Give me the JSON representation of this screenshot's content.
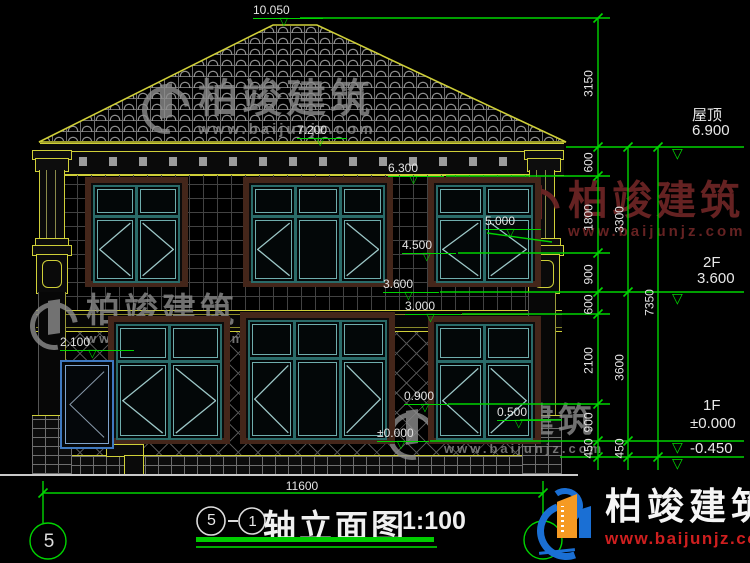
{
  "levels": [
    "10.050",
    "7.200",
    "6.300",
    "5.000",
    "4.500",
    "3.600",
    "3.000",
    "2.100",
    "0.900",
    "0.500",
    "±0.000"
  ],
  "right_panel": {
    "roof_label": "屋顶",
    "roof_level": "6.900",
    "floor2_label": "2F",
    "floor2_level": "3.600",
    "floor1_label": "1F",
    "floor1_level": "±0.000",
    "basement_level": "-0.450",
    "col1": [
      "3150",
      "600",
      "1800",
      "900",
      "600",
      "2100",
      "900",
      "450"
    ],
    "col2": [
      "3300",
      "3600",
      "450"
    ],
    "col3": [
      "7350"
    ]
  },
  "bottom": {
    "overall_dim": "11600",
    "axis_left": "5"
  },
  "title": {
    "axis_a": "5",
    "dash": "-",
    "axis_b": "1",
    "name": "轴立面图",
    "scale": "1:100"
  },
  "brand": {
    "name": "柏竣建筑",
    "url": "www.baijunjz.com"
  },
  "colors": {
    "line_green": "#00d400",
    "cad_yellow": "#cfcf38",
    "frame_teal": "#2a6b69",
    "surround_brown": "#44261a",
    "logo_blue": "#1a6fd4",
    "logo_orange": "#f59a23",
    "url_red": "#cf1f1f",
    "watermark_gray": "#8d8d8d",
    "watermark_maroon": "#6b2424"
  }
}
